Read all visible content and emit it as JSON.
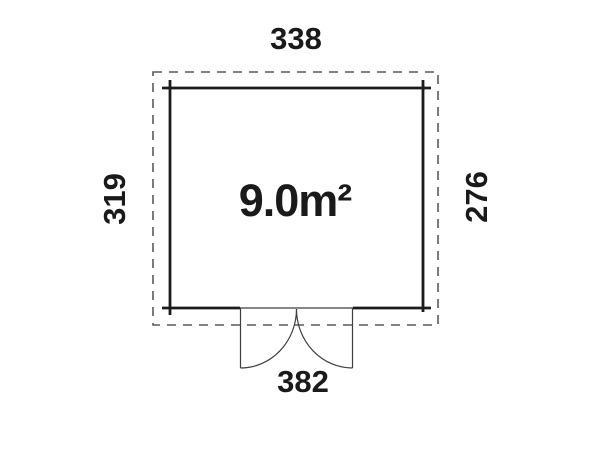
{
  "plan": {
    "area_label": "9.0m²",
    "dimensions": {
      "top": "338",
      "left": "319",
      "right": "276",
      "bottom": "382"
    }
  },
  "colors": {
    "background": "#ffffff",
    "wall": "#1c1c1c",
    "dashed_outline": "#5a5a5a",
    "door": "#3f3f3f",
    "text": "#1a1a1a"
  }
}
